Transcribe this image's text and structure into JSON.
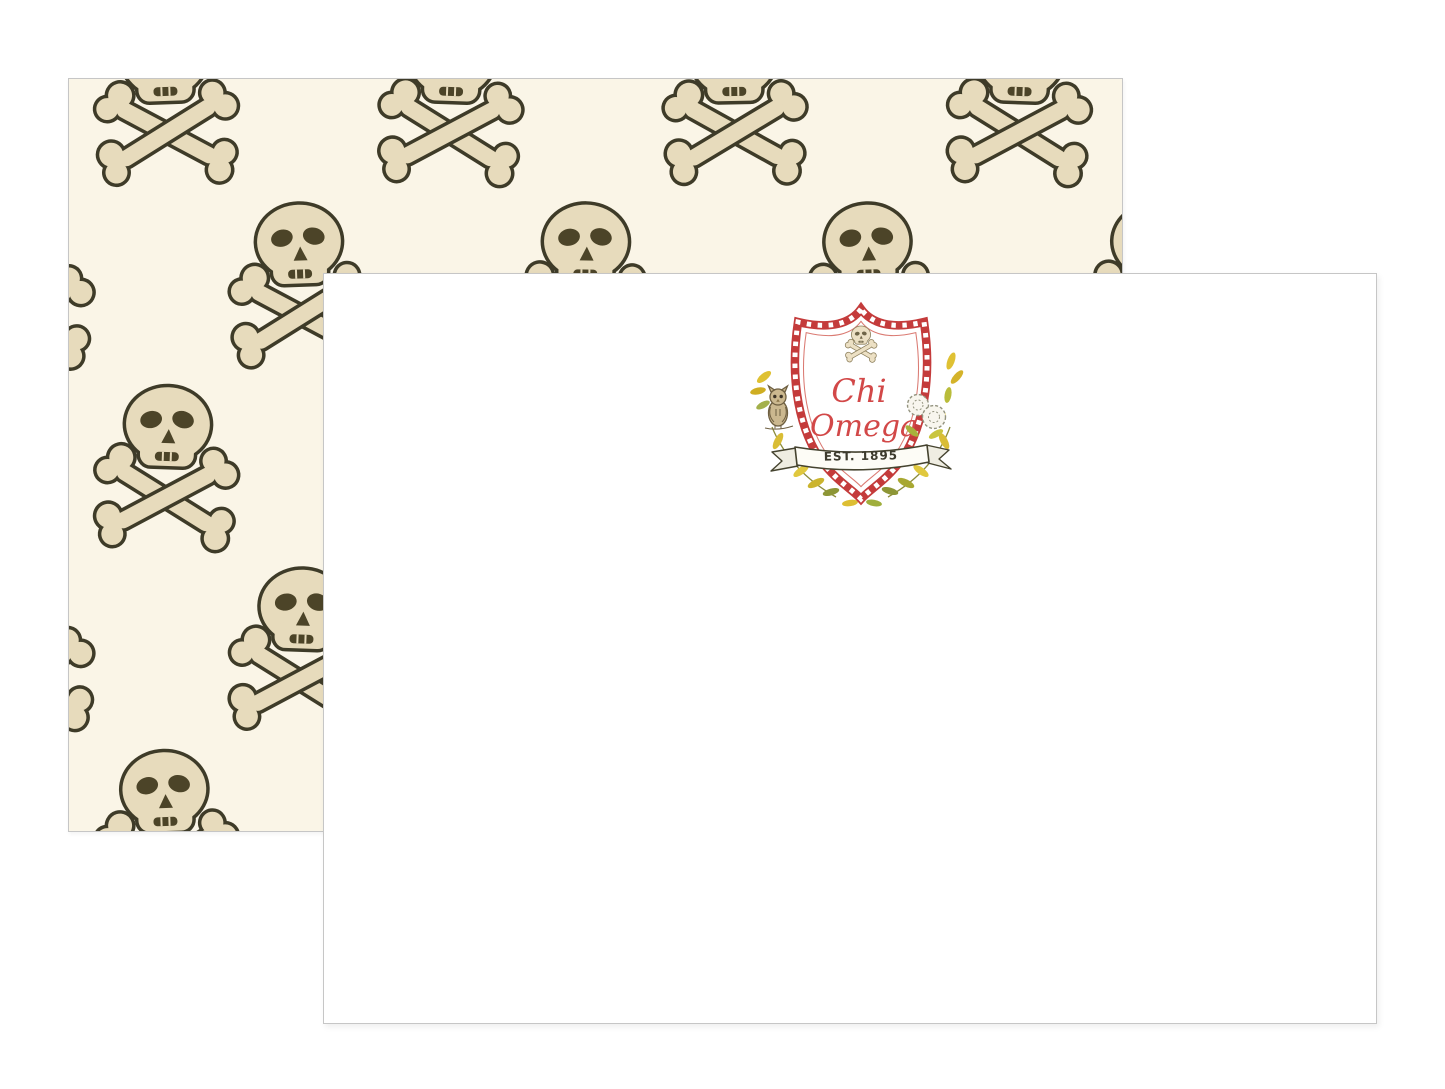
{
  "colors": {
    "page_bg": "#ffffff",
    "card_cream": "#faf5e7",
    "card_border": "#c6c6c6",
    "pattern_ink": "#3e3b28",
    "bone_fill": "#e7dbbc",
    "eye_ink": "#4c4428",
    "crest_red": "#c43b3b",
    "script_red": "#d24848",
    "banner_ink": "#45432f",
    "gold": "#ddbe33",
    "olive": "#8d9636",
    "leaf_green": "#b8bc3a",
    "owl_brown": "#cbb88f",
    "owl_ink": "#6e5f41",
    "flower_ink": "#93937f"
  },
  "front_card": {
    "crest": {
      "name_line1": "Chi",
      "name_line2": "Omega",
      "banner_text": "EST. 1895",
      "icons": [
        "skull-crossbones-icon",
        "owl-icon",
        "carnation-flowers-icon",
        "laurel-leaves-icon"
      ]
    }
  },
  "back_card": {
    "pattern_icon": "skull-crossbones-pattern"
  }
}
